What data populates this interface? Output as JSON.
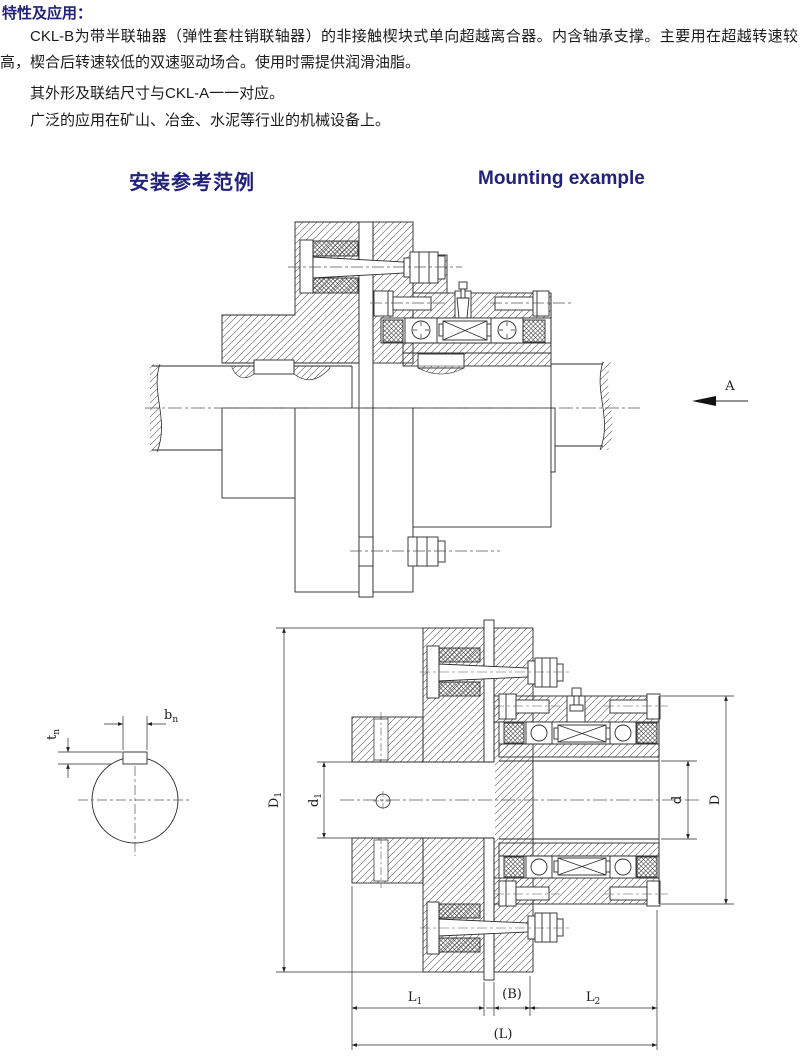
{
  "page": {
    "section_title": "特性及应用：",
    "paragraphs": [
      "CKL-B为带半联轴器（弹性套柱销联轴器）的非接触楔块式单向超越离合器。内含轴承支撑。主要用在超越转速较高，楔合后转速较低的双速驱动场合。使用时需提供润滑油脂。",
      "其外形及联结尺寸与CKL-A一一对应。",
      "广泛的应用在矿山、冶金、水泥等行业的机械设备上。"
    ],
    "heading_cn": "安装参考范例",
    "heading_en": "Mounting example"
  },
  "colors": {
    "heading": "#22227c",
    "body_text": "#1c1c1c",
    "line": "#2a2a2a"
  },
  "dims": {
    "view_arrow": "A",
    "bn": {
      "base": "b",
      "sub": "n"
    },
    "tn": {
      "base": "t",
      "sub": "n"
    },
    "D1": {
      "base": "D",
      "sub": "1"
    },
    "d1": {
      "base": "d",
      "sub": "1"
    },
    "d": {
      "base": "d",
      "sub": ""
    },
    "D": {
      "base": "D",
      "sub": ""
    },
    "L1": {
      "base": "L",
      "sub": "1"
    },
    "B": {
      "base": "(B)",
      "sub": ""
    },
    "L2": {
      "base": "L",
      "sub": "2"
    },
    "L": {
      "base": "(L)",
      "sub": ""
    }
  }
}
